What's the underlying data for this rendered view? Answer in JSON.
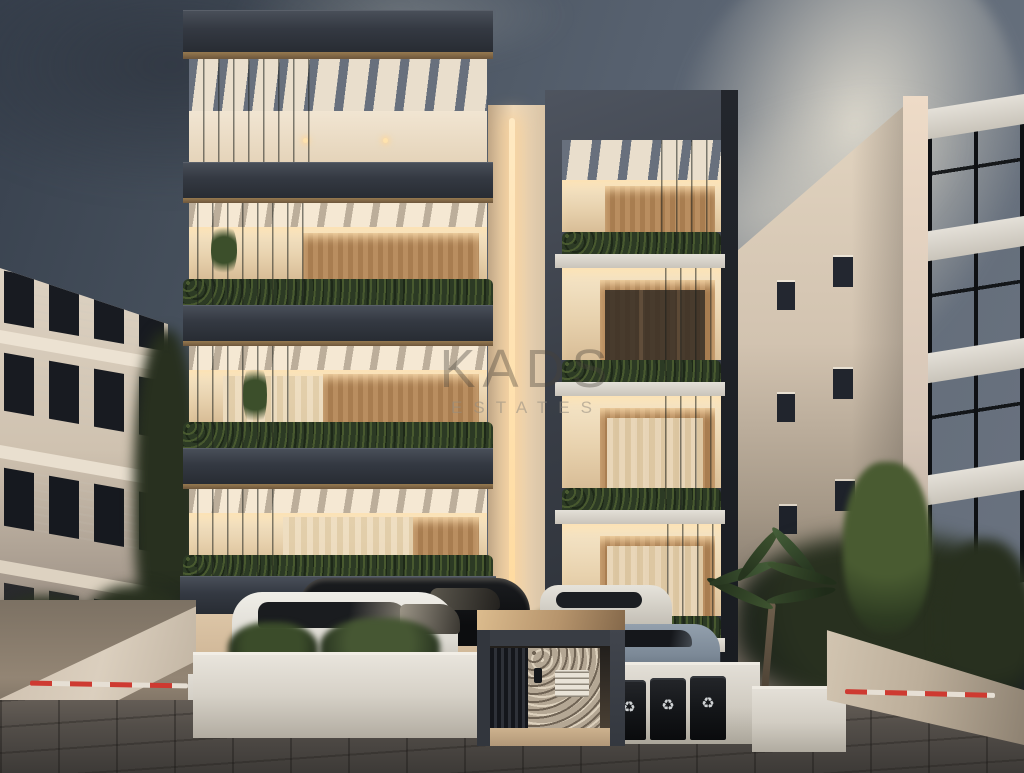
{
  "watermark": {
    "line1": "KADS",
    "line2": "ESTATES"
  },
  "icons": {
    "recycle": "♻"
  },
  "scene": {
    "type": "architectural-dusk-render",
    "elements": [
      "modern apartment building with two towers",
      "vertical led light strip between towers",
      "dark concrete balcony slabs with pergola beams",
      "balcony hedge planters and hanging vines",
      "warm lit interiors with wood panelling and curtains",
      "covered ground-floor parking with cars",
      "entrance gate with stone wall and mailboxes",
      "three black recycling bins",
      "palm tree and street trees",
      "driveway ramps with red-white barrier arms",
      "neighbouring beige apartment buildings",
      "modern glass building at far right",
      "stormy evening sky with bright cloud",
      "stone paved street"
    ]
  },
  "colors": {
    "sky_dark": "#38414e",
    "sky_mid": "#57616f",
    "cloud_bright": "#d9d4c7",
    "slab_dark": "#343942",
    "wall_cream": "#e6d9c6",
    "interior_warm": "#e8d2ae",
    "wood": "#b08457",
    "hedge_green": "#2c3a24",
    "led_glow": "#ffe2b0",
    "planter_white": "#e3dfd7",
    "street_paver": "#524e49",
    "barrier_red": "#ce3a31",
    "car_white": "#eceae4",
    "car_black": "#101214",
    "car_blue_gray": "#7f8c9a",
    "left_building": "#d6cabb",
    "right_building": "#d9cbb9",
    "glass_dark": "#262b33"
  }
}
